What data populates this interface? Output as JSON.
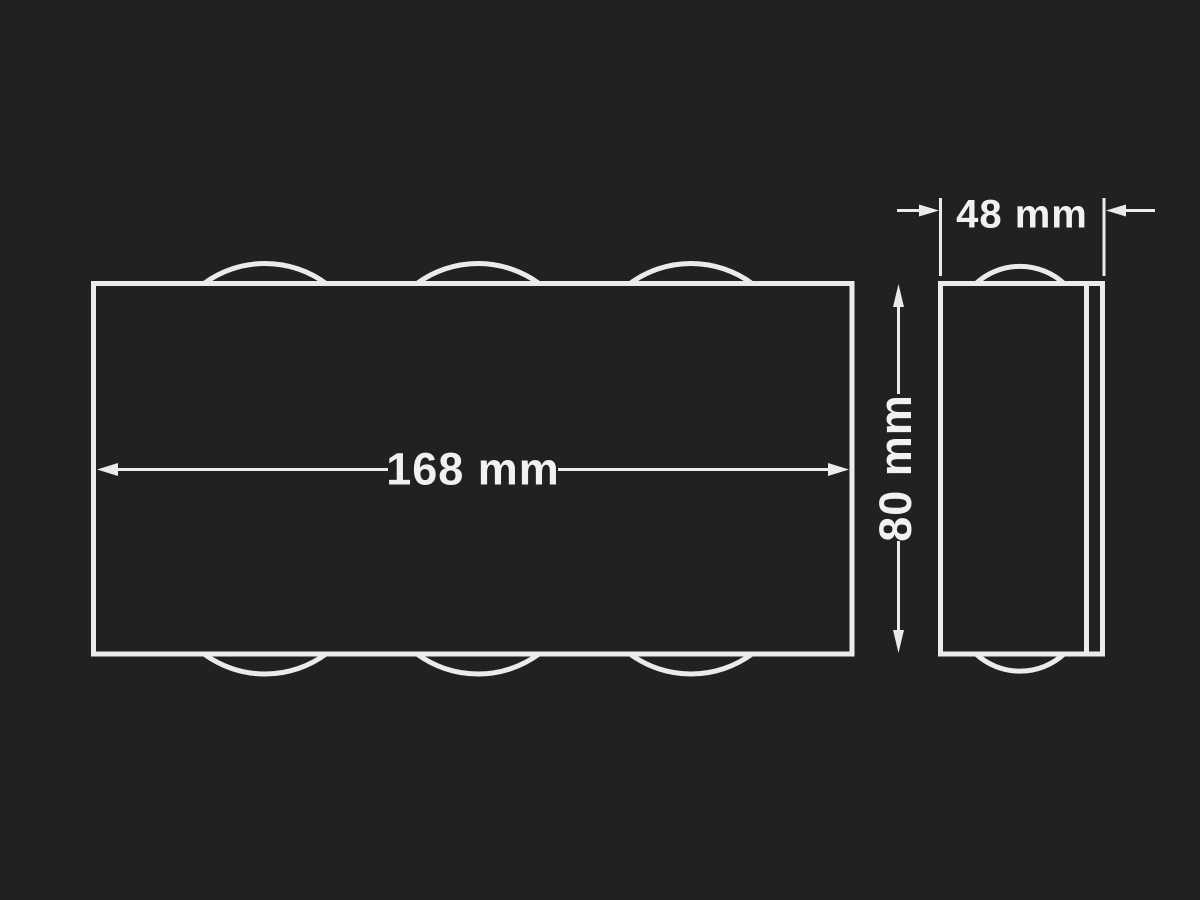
{
  "colors": {
    "background": "#232021",
    "line": "#ECEBEA",
    "text": "#F2F1F0"
  },
  "dimensions": {
    "width": {
      "label": "168 mm"
    },
    "depth": {
      "label": "48 mm"
    },
    "height": {
      "label": "80 mm"
    }
  }
}
